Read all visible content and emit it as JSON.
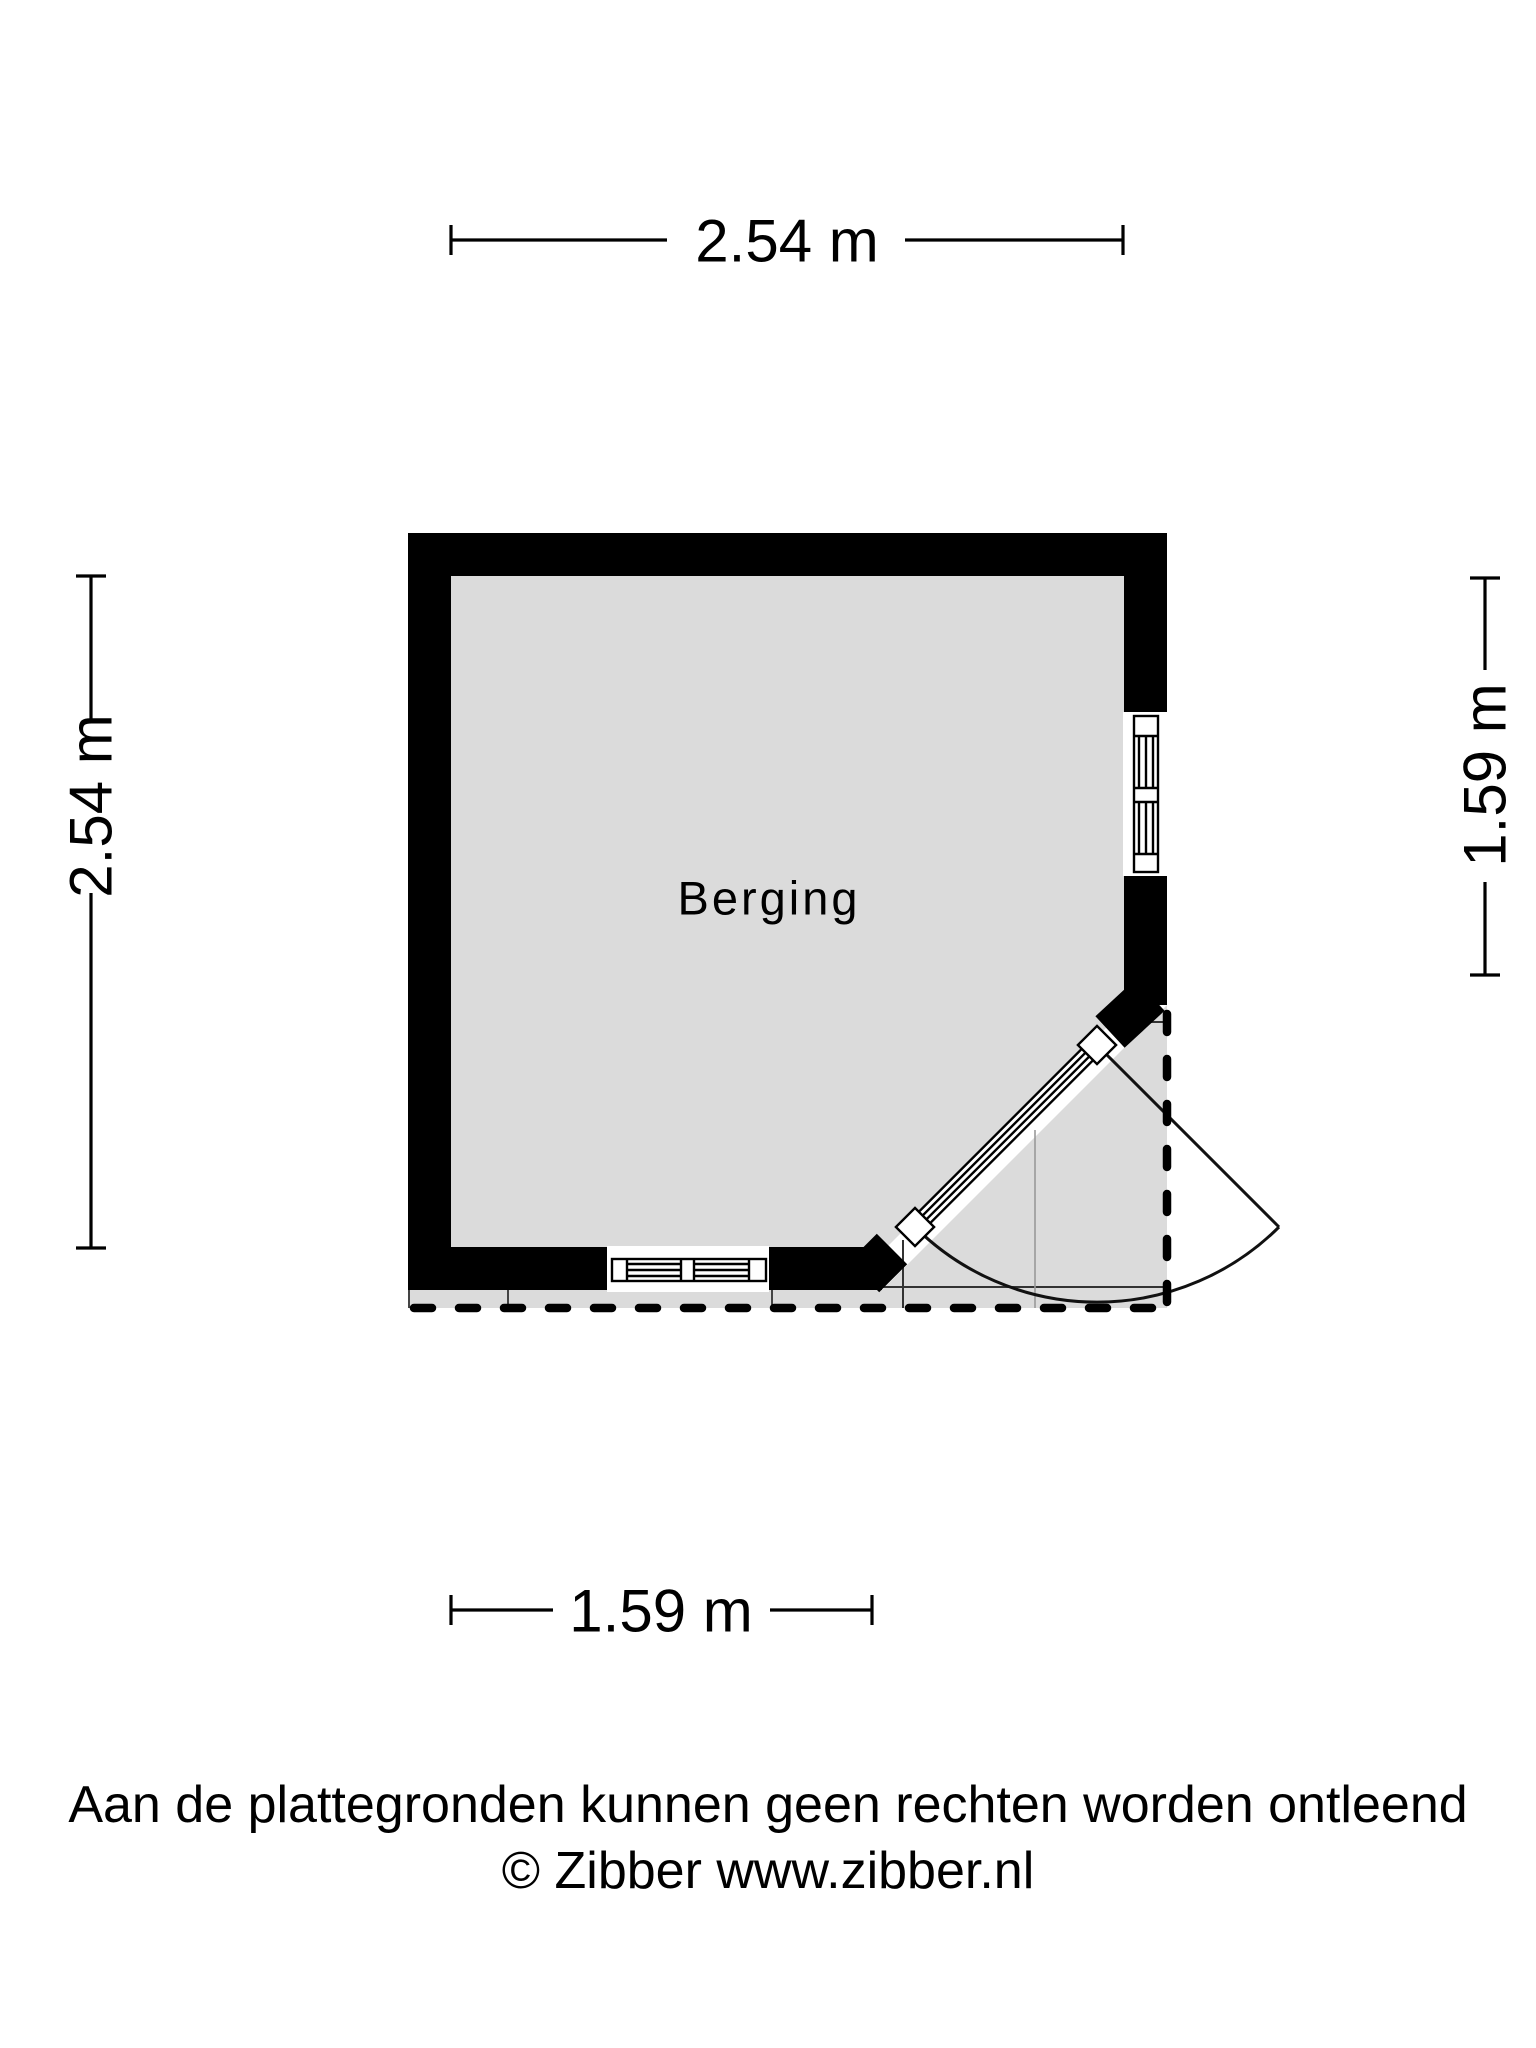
{
  "floor_plan": {
    "room": {
      "label": "Berging"
    },
    "dimensions": {
      "top_width": "2.54 m",
      "left_height": "2.54 m",
      "right_height": "1.59 m",
      "bottom_width": "1.59 m"
    },
    "colors": {
      "wall": "#000000",
      "floor": "#dbdbdb",
      "line": "#000000",
      "background": "#ffffff"
    }
  },
  "footer": {
    "disclaimer": "Aan de plattegronden kunnen geen rechten worden ontleend",
    "copyright": "© Zibber www.zibber.nl"
  }
}
